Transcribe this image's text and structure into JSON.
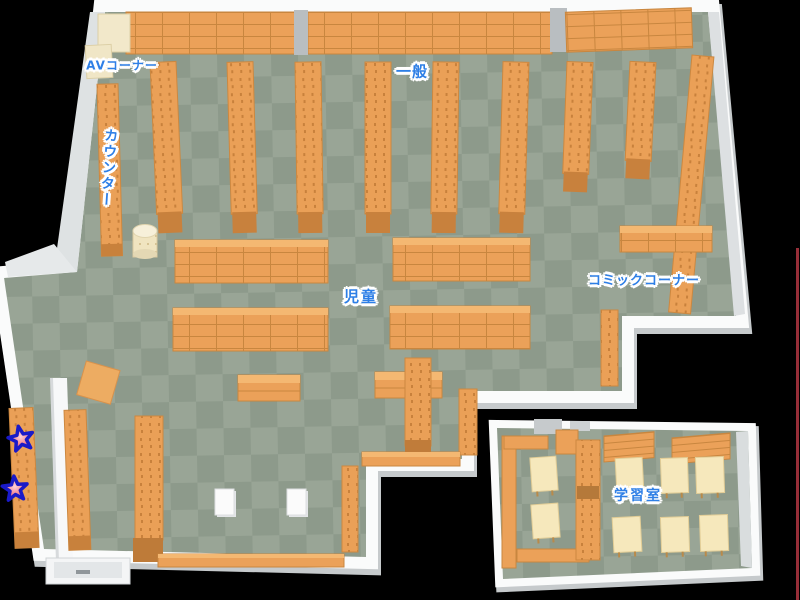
{
  "map": {
    "background": "#000000",
    "areas": [
      {
        "id": "av-corner",
        "label": "AVコーナー"
      },
      {
        "id": "counter",
        "label": "カウンター"
      },
      {
        "id": "general",
        "label": "一般"
      },
      {
        "id": "children",
        "label": "児童"
      },
      {
        "id": "comic-corner",
        "label": "コミックコーナー"
      },
      {
        "id": "study-room",
        "label": "学習室"
      }
    ],
    "markers": {
      "star_count": 2,
      "star_fill": "#E8404E",
      "star_outline": "#1A1AC8"
    },
    "colors": {
      "floor_light": "#99A596",
      "floor_dark": "#8D9A8B",
      "shelf": "#EBA159",
      "shelf_top": "#F4B872",
      "shelf_base": "#C07B38",
      "wall": "#FAFBFB",
      "wall_shade": "#C6CACC",
      "table": "#F6E8BC",
      "av_shelf": "#F2E8CA",
      "label_text": "#2E7FE6",
      "label_outline": "#FFFFFF",
      "edge_line": "#B23642"
    }
  }
}
